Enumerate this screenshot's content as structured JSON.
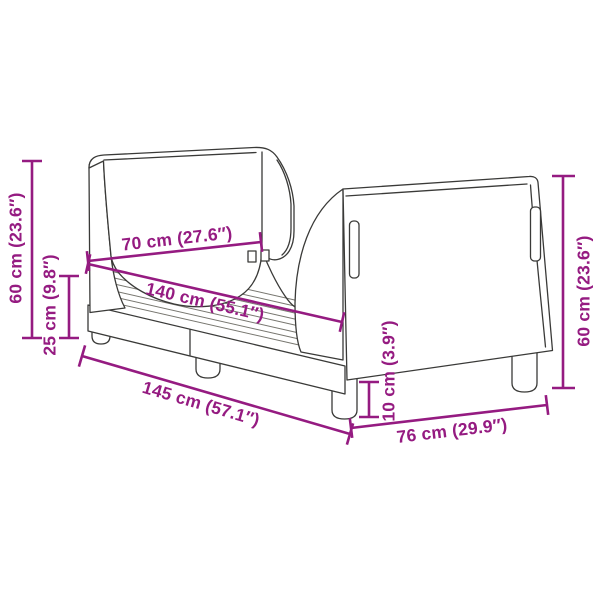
{
  "diagram": {
    "title": "Bed frame dimension diagram",
    "product": "upholstered bed frame with winged headboard and footboard"
  },
  "colors": {
    "dimension_accent": "#951B81",
    "line_art": "#3A3A38",
    "slat_line": "#77766F",
    "background": "#FFFFFF"
  },
  "dimensions": {
    "left_height": {
      "label": "60 cm (23.6″)",
      "orientation": "vertical"
    },
    "base_height": {
      "label": "25 cm (9.8″)",
      "orientation": "vertical"
    },
    "inner_width": {
      "label": "70 cm (27.6″)",
      "orientation": "diagonal"
    },
    "inner_length": {
      "label": "140 cm (55.1″)",
      "orientation": "diagonal"
    },
    "outer_length": {
      "label": "145 cm (57.1″)",
      "orientation": "diagonal"
    },
    "leg_height": {
      "label": "10 cm (3.9″)",
      "orientation": "vertical"
    },
    "outer_width": {
      "label": "76 cm (29.9″)",
      "orientation": "diagonal"
    },
    "right_height": {
      "label": "60 cm (23.6″)",
      "orientation": "vertical"
    }
  }
}
